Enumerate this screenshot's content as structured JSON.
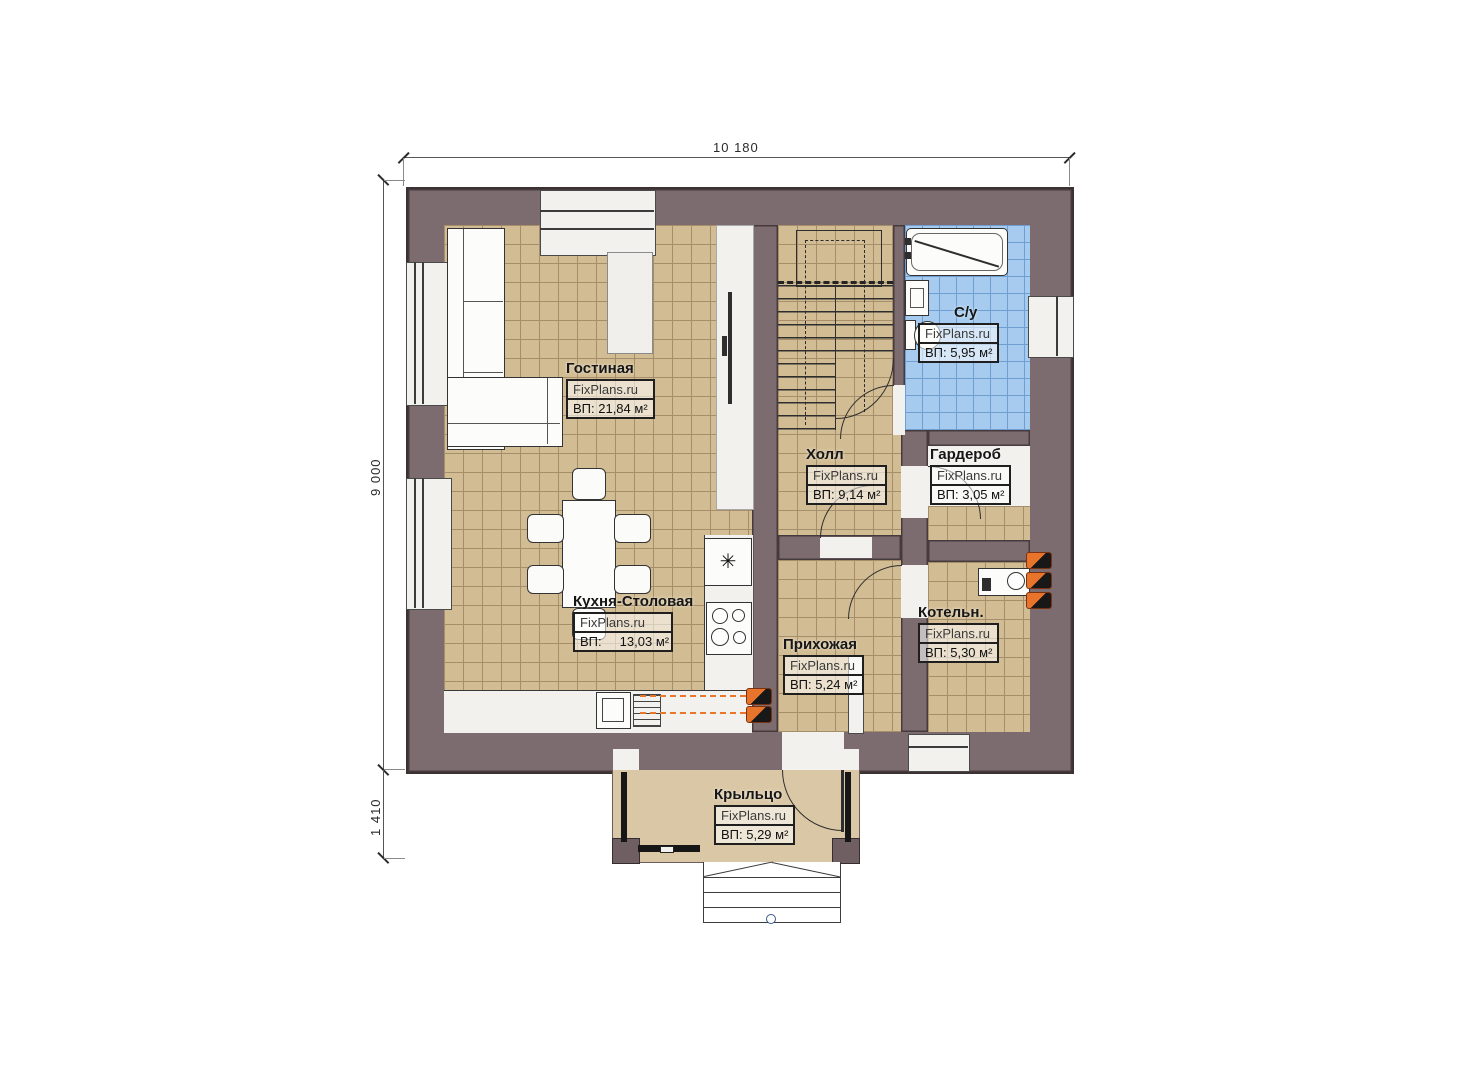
{
  "watermark": "FixPlans.ru",
  "dimensions": {
    "top": "10 180",
    "left": "9 000",
    "bottom_left": "1 410"
  },
  "symbols": {
    "kitchen_unit": "✳"
  },
  "rooms": [
    {
      "name": "Гостиная",
      "area": "ВП: 21,84 м²"
    },
    {
      "name": "Кухня-Столовая",
      "area": "ВП:     13,03 м²"
    },
    {
      "name": "Холл",
      "area": "ВП: 9,14 м²"
    },
    {
      "name": "С/у",
      "area": "ВП: 5,95 м²"
    },
    {
      "name": "Гардероб",
      "area": "ВП: 3,05 м²"
    },
    {
      "name": "Котельн.",
      "area": "ВП: 5,30 м²"
    },
    {
      "name": "Прихожая",
      "area": "ВП: 5,24 м²"
    },
    {
      "name": "Крыльцо",
      "area": "ВП: 5,29 м²"
    }
  ],
  "colors": {
    "wall": "#7d6c6f",
    "floor": "#d2bc93",
    "bathroom": "#a6cbee",
    "accent": "#e8732a"
  }
}
